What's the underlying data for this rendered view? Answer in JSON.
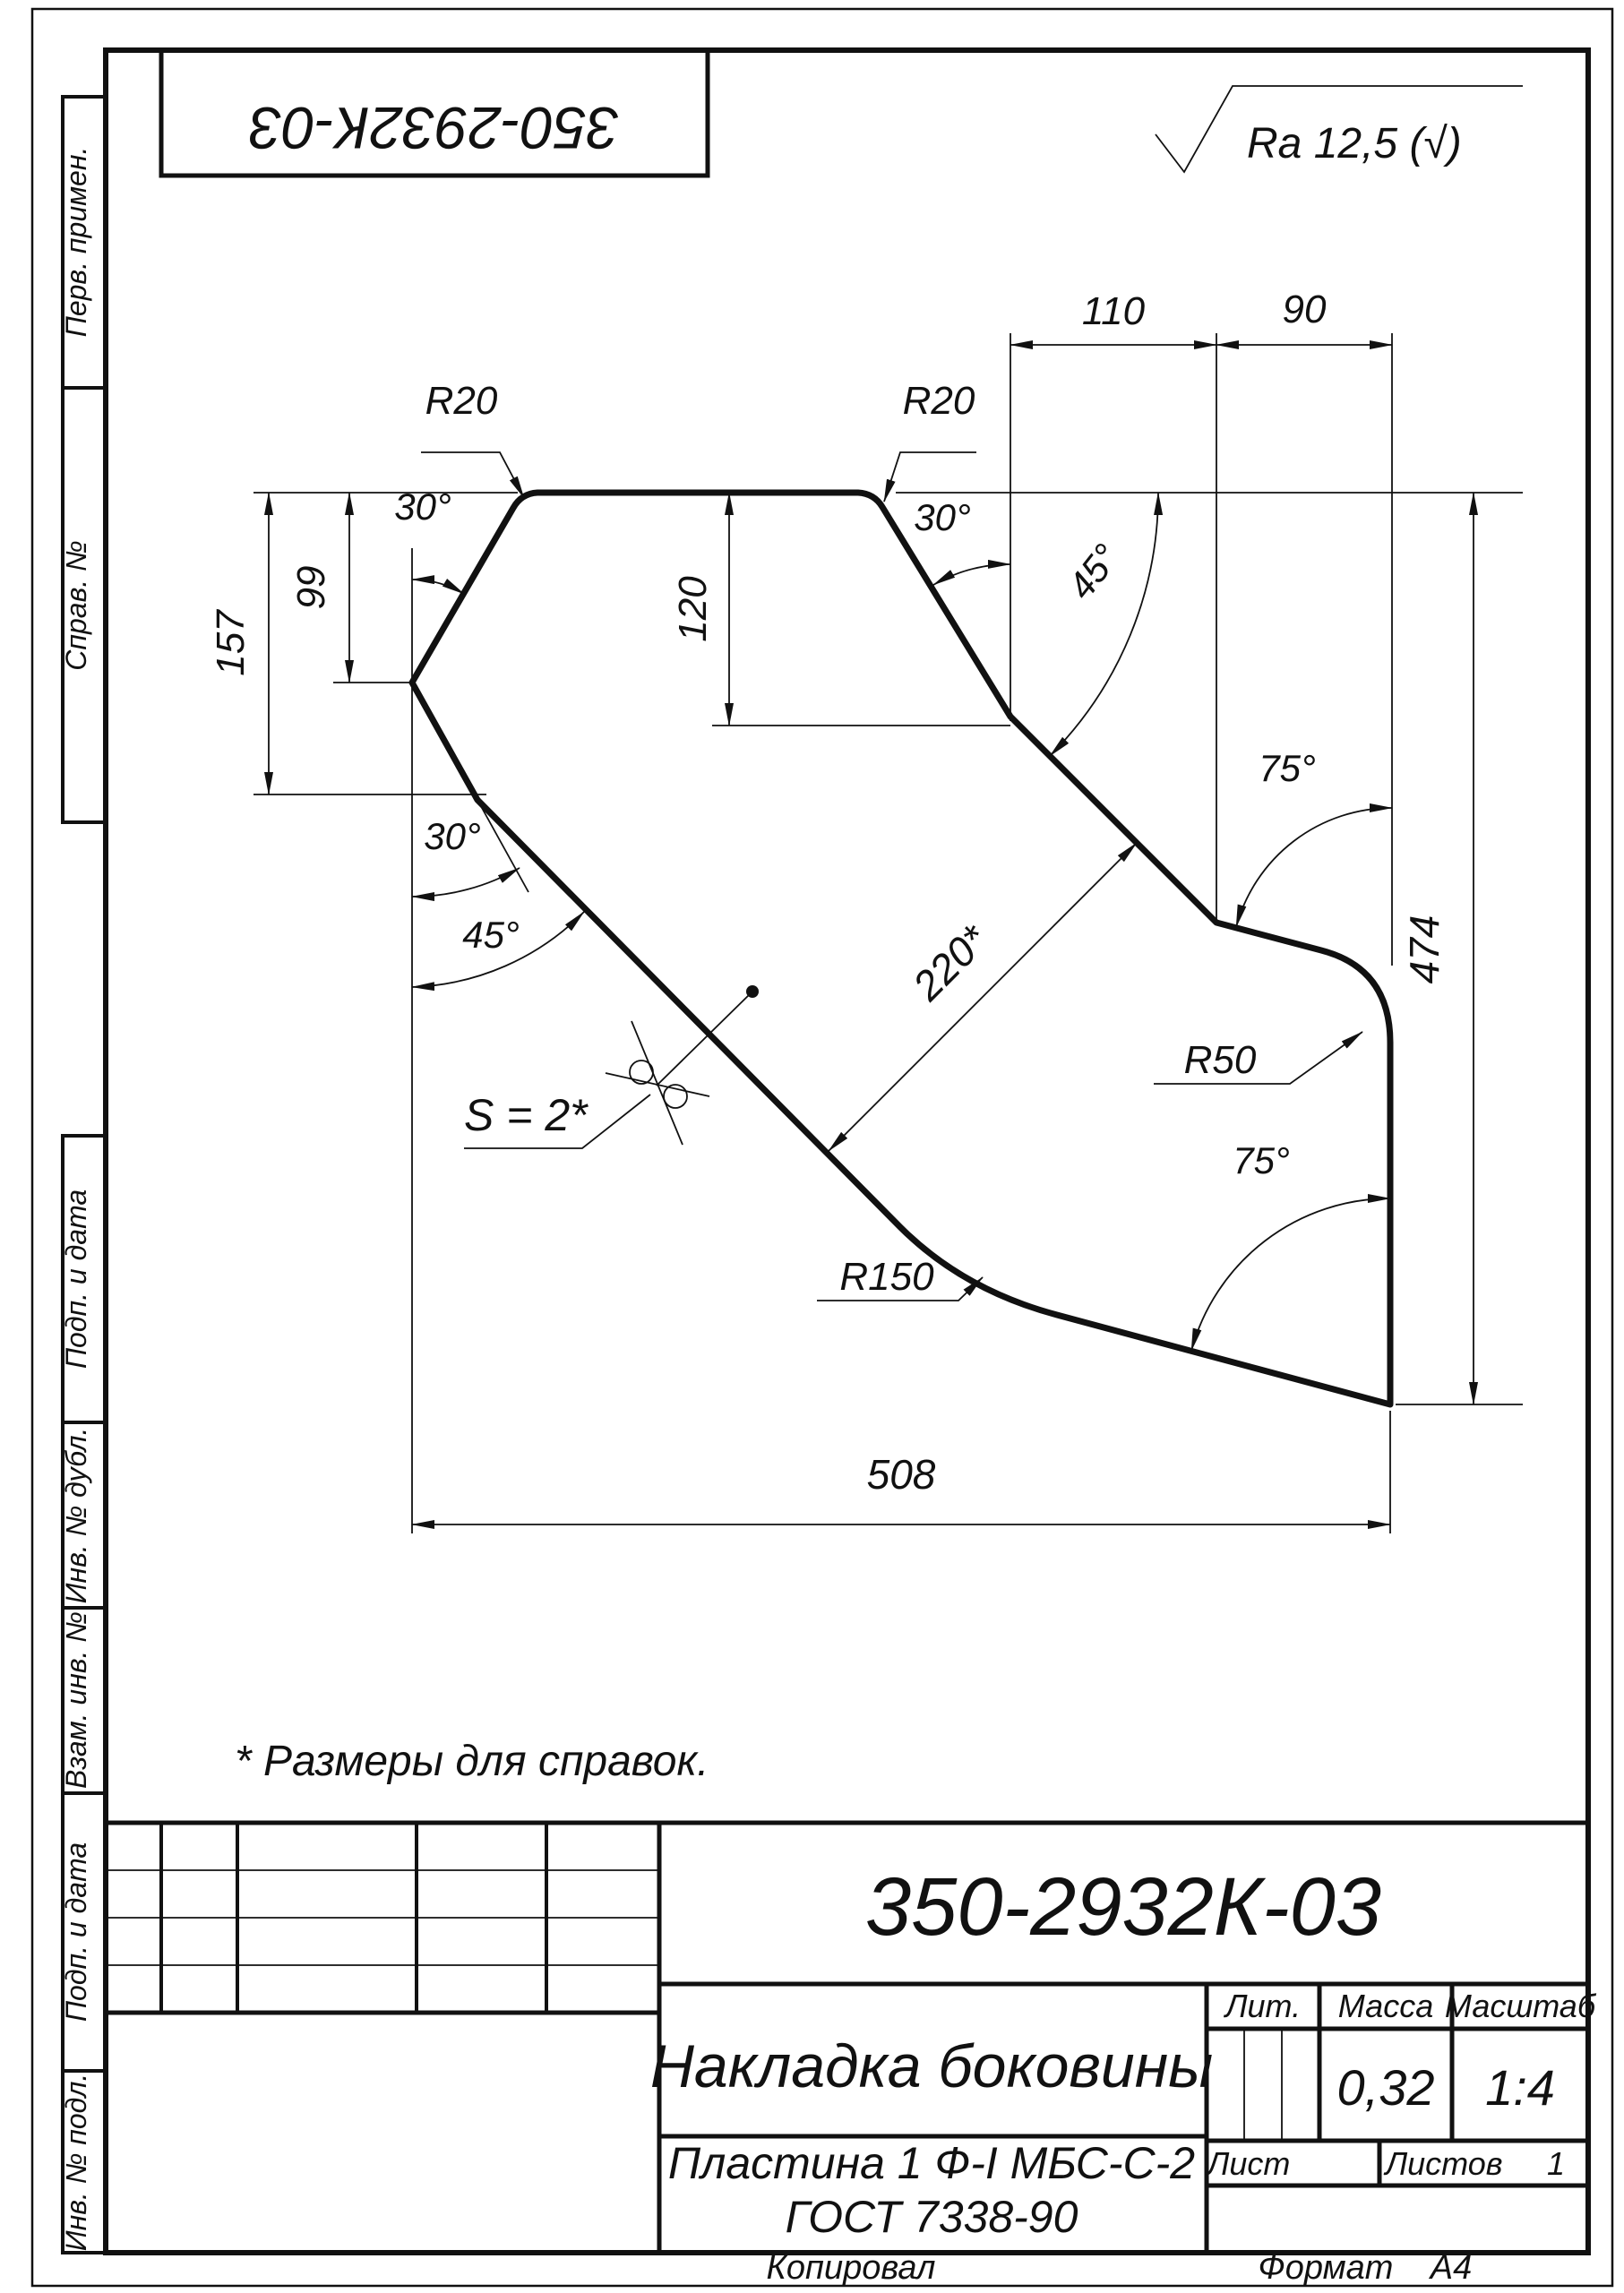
{
  "sheet": {
    "stamp_top": "350-2932К-03",
    "roughness": "Ra 12,5 (√)",
    "note": "* Размеры для справок.",
    "margin_labels": [
      "Перв. примен.",
      "Справ. №",
      "Подп. и дата",
      "Инв. № дубл.",
      "Взам. инв. №",
      "Подп. и дата",
      "Инв. № подл."
    ]
  },
  "dimensions": {
    "d110": "110",
    "d90": "90",
    "d120": "120",
    "d99": "99",
    "d157": "157",
    "d220": "220*",
    "d474": "474",
    "d508": "508",
    "r20_left": "R20",
    "r20_right": "R20",
    "r50": "R50",
    "r150": "R150",
    "a30_top_left": "30°",
    "a30_top_right": "30°",
    "a30_lower_left": "30°",
    "a45_lower_left": "45°",
    "a45_upper_right": "45°",
    "a75_top": "75°",
    "a75_bottom": "75°",
    "thickness": "S = 2*"
  },
  "title_block": {
    "designation": "350-2932К-03",
    "name": "Накладка боковины",
    "material_line1": "Пластина 1 Ф-I МБС-С-2",
    "material_line2": "ГОСТ 7338-90",
    "lit_label": "Лит.",
    "mass_label": "Масса",
    "scale_label": "Масштаб",
    "mass_value": "0,32",
    "scale_value": "1:4",
    "sheet_label": "Лист",
    "sheets_label": "Листов",
    "sheets_value": "1",
    "copied_label": "Копировал",
    "format_label": "Формат",
    "format_value": "А4"
  }
}
